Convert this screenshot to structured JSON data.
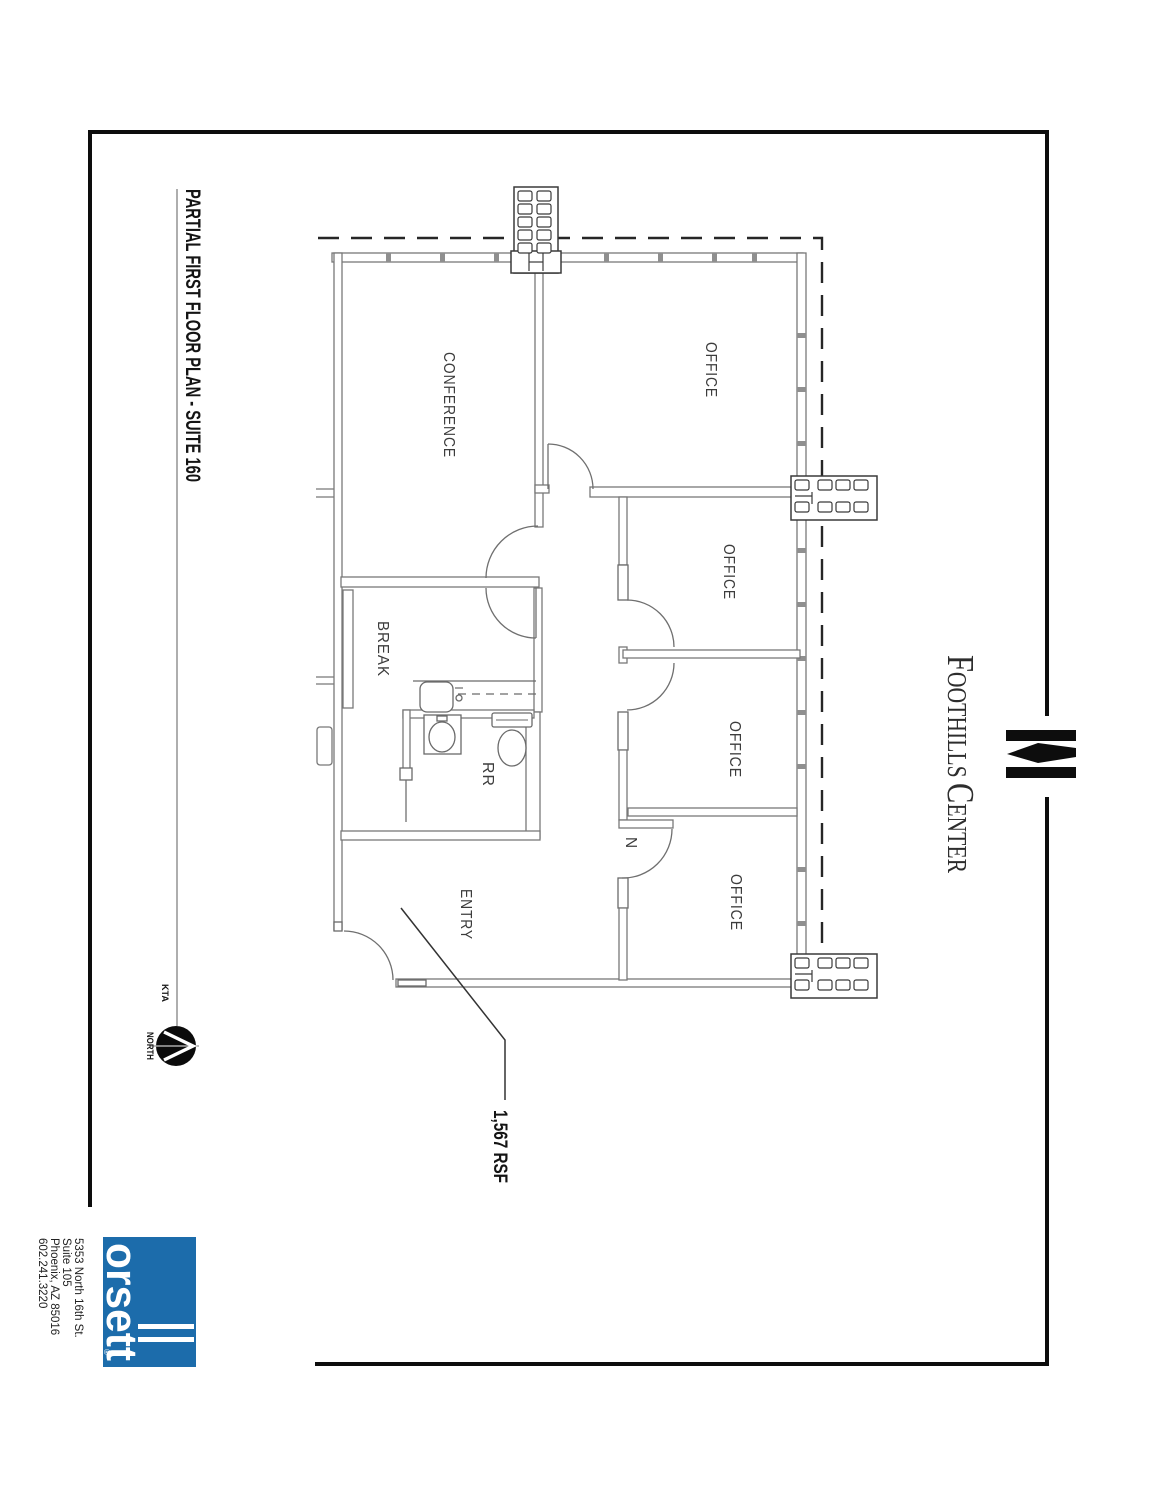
{
  "sheet": {
    "title": "PARTIAL FIRST FLOOR PLAN - SUITE 160",
    "area_callout": "1,567 RSF",
    "north_label": "NORTH",
    "firm_initials": "KTA"
  },
  "plan": {
    "room_labels": {
      "conference": "CONFERENCE",
      "office": "OFFICE",
      "break_room": "BREAK",
      "restroom": "RR",
      "entry": "ENTRY",
      "door_tag": "N"
    }
  },
  "branding": {
    "property_name": {
      "word1_initial": "F",
      "word1_rest": "OOTHILLS",
      "word2_initial": "C",
      "word2_rest": "ENTER"
    },
    "logo_word": "orsett",
    "registered_mark": "®",
    "logo_color": "#1c6cab",
    "address_lines": [
      "5353 North 16th St.",
      "Suite 105",
      "Phoenix, AZ  85016",
      "602.241.3220"
    ]
  }
}
